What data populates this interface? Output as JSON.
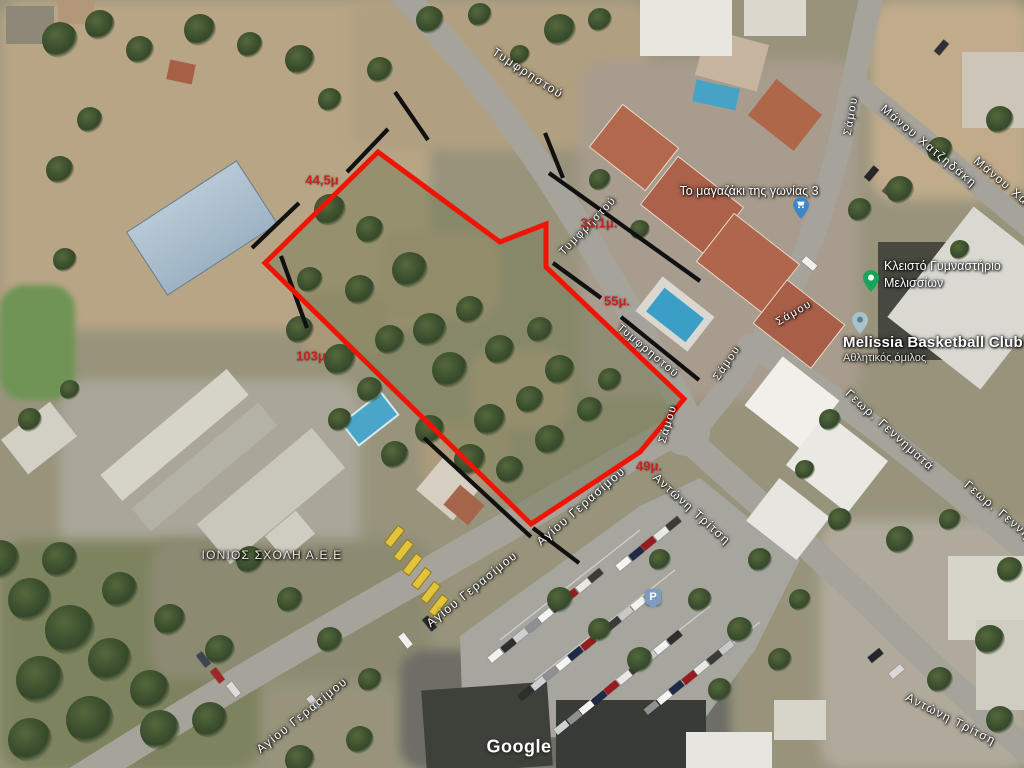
{
  "map": {
    "attribution": "Google",
    "streets": {
      "tymfristou": "Τυμφρηστού",
      "samou": "Σάμου",
      "manou_chatzidaki": "Μάνου Χατζηδάκη",
      "agiou_gerasimou": "Αγίου Γερασίμου",
      "antoni_tritsi": "Αντώνη Τρίτση",
      "geor_gennimata": "Γεωρ. Γεννηματά"
    },
    "pois": {
      "shop": {
        "label": "Το μαγαζάκι της γωνίας 3"
      },
      "gym": {
        "label_line1": "Κλειστό Γυμναστήριο",
        "label_line2": "Μελισσίων"
      },
      "basketball": {
        "name": "Melissia Basketball Club",
        "subtitle": "Αθλητικός όμιλος"
      },
      "school": {
        "label": "ΙΟΝΙΟΣ ΣΧΟΛΗ Α.Ε.Ε"
      },
      "parking": {
        "label": "P"
      }
    },
    "dimensions": {
      "d1": "44,5μ",
      "d2": "31,1μ.",
      "d3": "55μ.",
      "d4": "103μ",
      "d5": "49μ."
    },
    "colors": {
      "parcel_outline": "#ee1507",
      "dimension_text": "#c42420",
      "shop_pin": "#3f86c6",
      "gym_pin": "#18a558",
      "basketball_pin": "#a9c2cc",
      "parking_icon": "#7d9cbf"
    }
  }
}
